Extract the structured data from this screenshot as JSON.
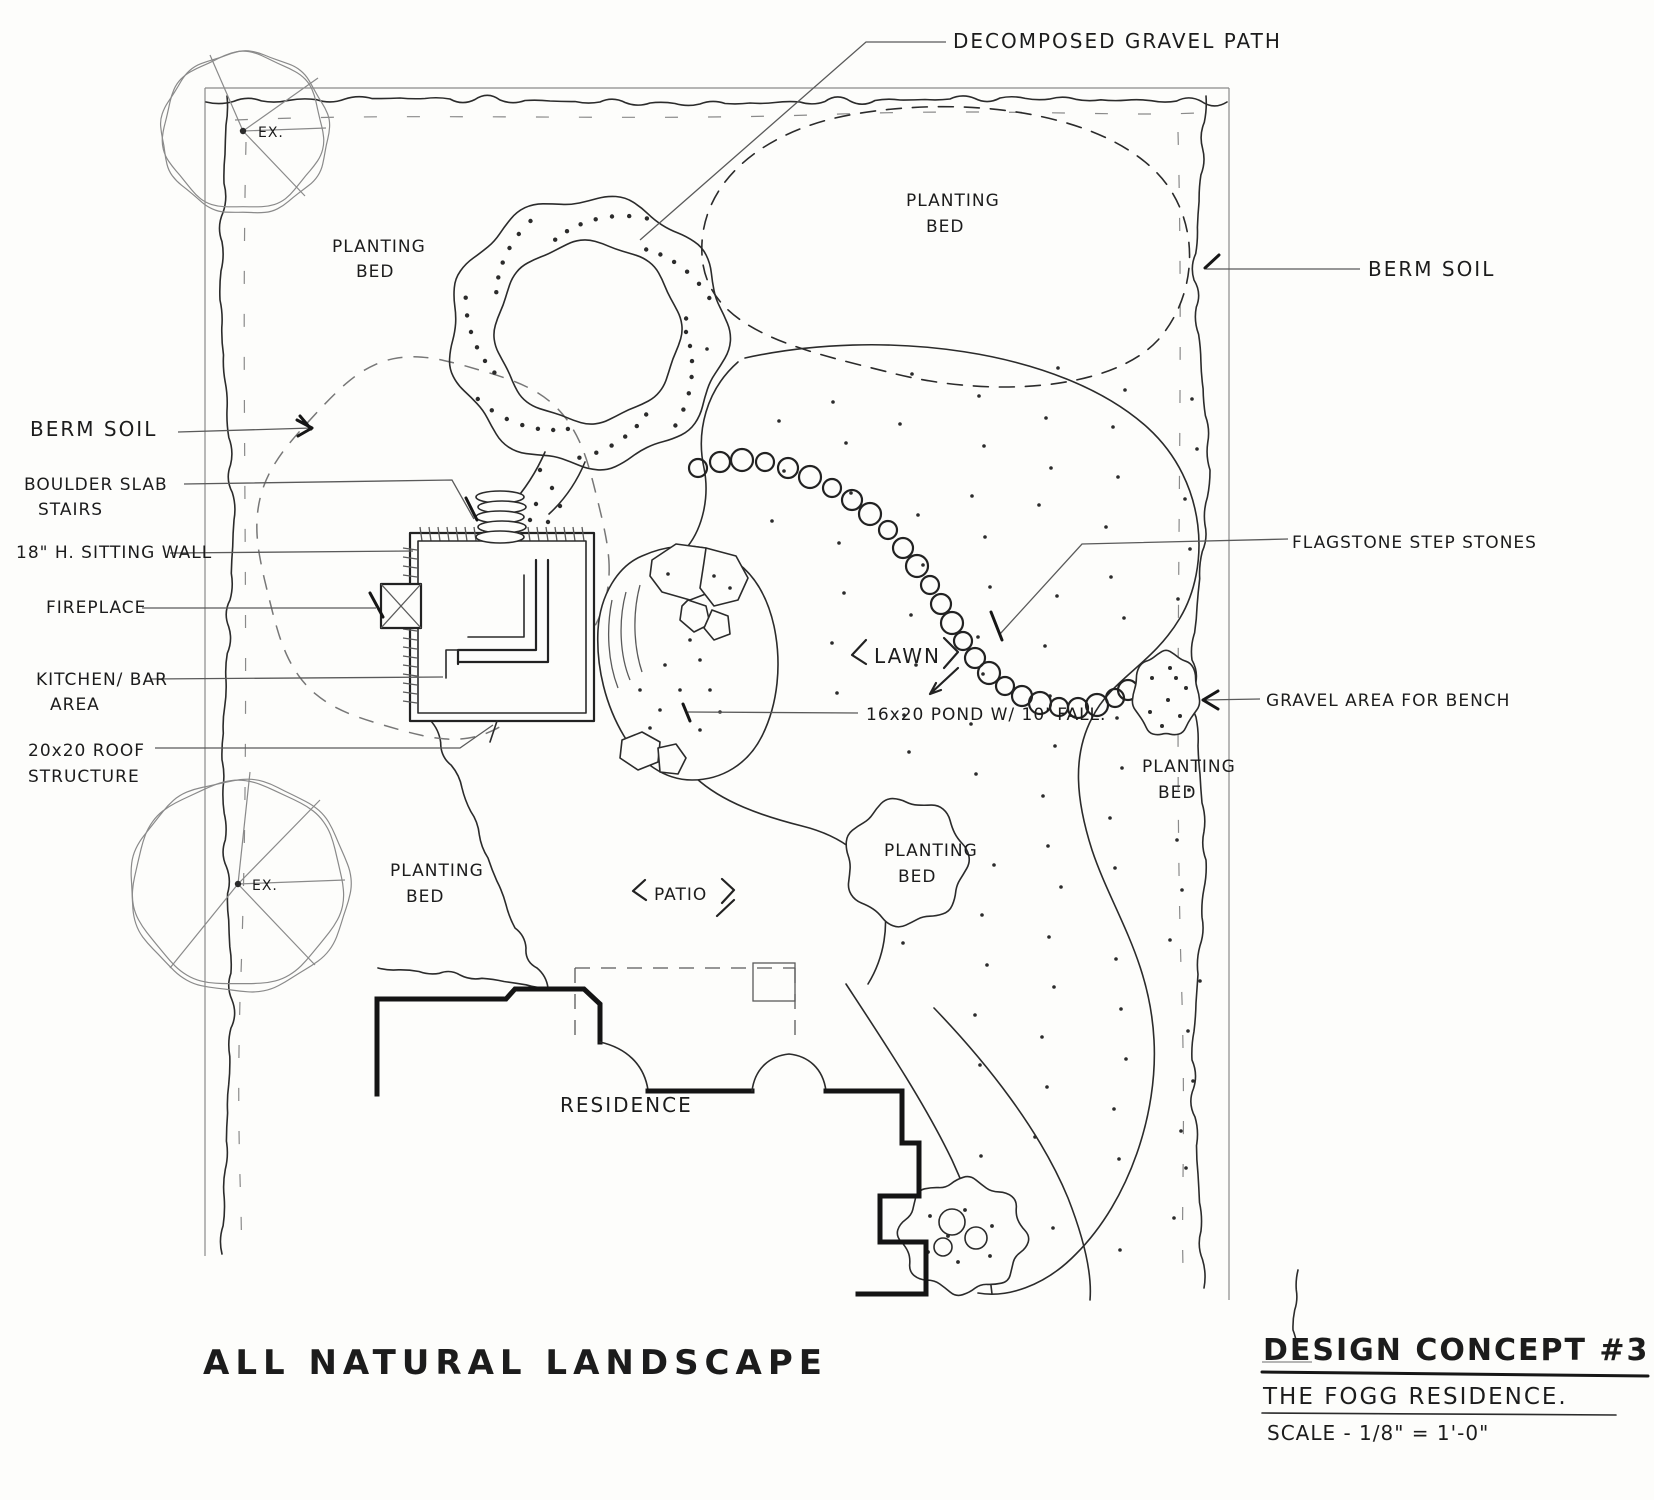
{
  "drawing_title": "ALL NATURAL LANDSCAPE",
  "title_block": {
    "concept_title": "DESIGN CONCEPT #3",
    "project_name": "THE FOGG RESIDENCE.",
    "scale_note": "SCALE - 1/8\" = 1'-0\""
  },
  "labels": {
    "decomposed_gravel_path": "DECOMPOSED GRAVEL PATH",
    "planting_bed_line1": "PLANTING",
    "planting_bed_line2": "BED",
    "berm_soil": "BERM SOIL",
    "boulder_slab_line1": "BOULDER SLAB",
    "boulder_slab_line2": "STAIRS",
    "sitting_wall": "18\" H. SITTING WALL",
    "fireplace": "FIREPLACE",
    "kitchen_bar_line1": "KITCHEN/ BAR",
    "kitchen_bar_line2": "AREA",
    "roof_structure_line1": "20x20 ROOF",
    "roof_structure_line2": "STRUCTURE",
    "flagstone_step_stones": "FLAGSTONE STEP STONES",
    "gravel_area_bench": "GRAVEL AREA FOR BENCH",
    "lawn": "LAWN",
    "pond": "16x20 POND W/ 10' FALL.",
    "patio": "PATIO",
    "residence": "RESIDENCE",
    "existing_tree": "EX."
  }
}
